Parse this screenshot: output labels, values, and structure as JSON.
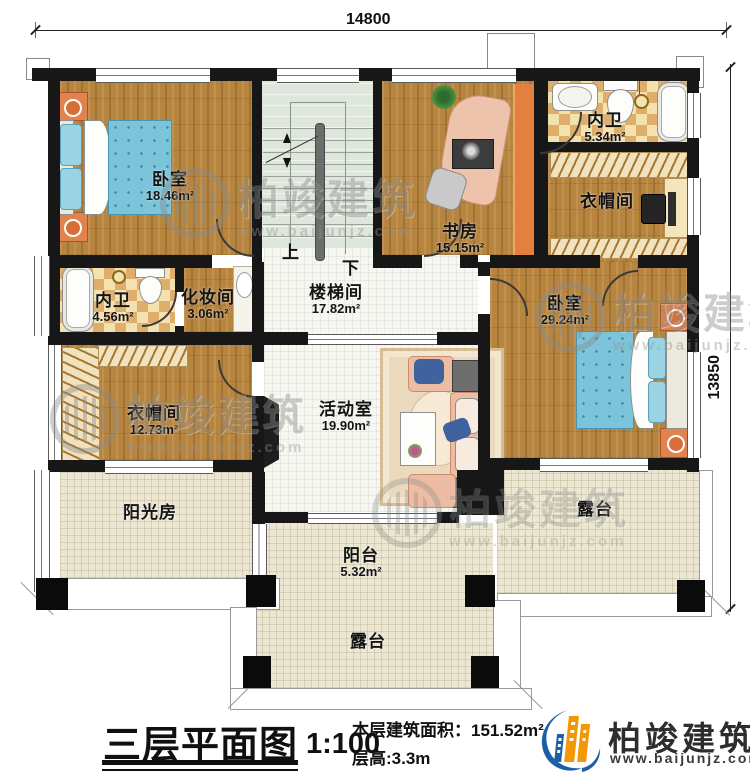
{
  "dimensions": {
    "top": "14800",
    "right": "13850"
  },
  "stairs": {
    "up": "上",
    "down": "下"
  },
  "rooms": {
    "bedroom_tl": {
      "name": "卧室",
      "area": "18.46m²"
    },
    "study": {
      "name": "书房",
      "area": "15.15m²"
    },
    "bath_tr": {
      "name": "内卫",
      "area": "5.34m²"
    },
    "closet_tr": {
      "name": "衣帽间"
    },
    "bath_left": {
      "name": "内卫",
      "area": "4.56m²"
    },
    "makeup": {
      "name": "化妆间",
      "area": "3.06m²"
    },
    "stair_hall": {
      "name": "楼梯间",
      "area": "17.82m²"
    },
    "bedroom_right": {
      "name": "卧室",
      "area": "29.24m²"
    },
    "closet_left": {
      "name": "衣帽间",
      "area": "12.73m²"
    },
    "activity": {
      "name": "活动室",
      "area": "19.90m²"
    },
    "sunroom": {
      "name": "阳光房"
    },
    "balcony": {
      "name": "阳台",
      "area": "5.32m²"
    },
    "terrace_right": {
      "name": "露台"
    },
    "terrace_bottom": {
      "name": "露台"
    }
  },
  "watermark": {
    "brand": "柏竣建筑",
    "url": "www.baijunjz.com"
  },
  "titleblock": {
    "title": "三层平面图",
    "scale": "1:100",
    "area_label": "本层建筑面积：",
    "area_value": "151.52m²",
    "height_label": "层高:",
    "height_value": "3.3m"
  },
  "logo": {
    "brand": "柏竣建筑",
    "url": "www.baijunjz.com"
  },
  "colors": {
    "wall": "#171717",
    "logo_blue": "#1d5fa7",
    "logo_orange": "#f39800",
    "bed_blue": "#7cc4da",
    "sofa_salmon": "#ecbda3"
  }
}
